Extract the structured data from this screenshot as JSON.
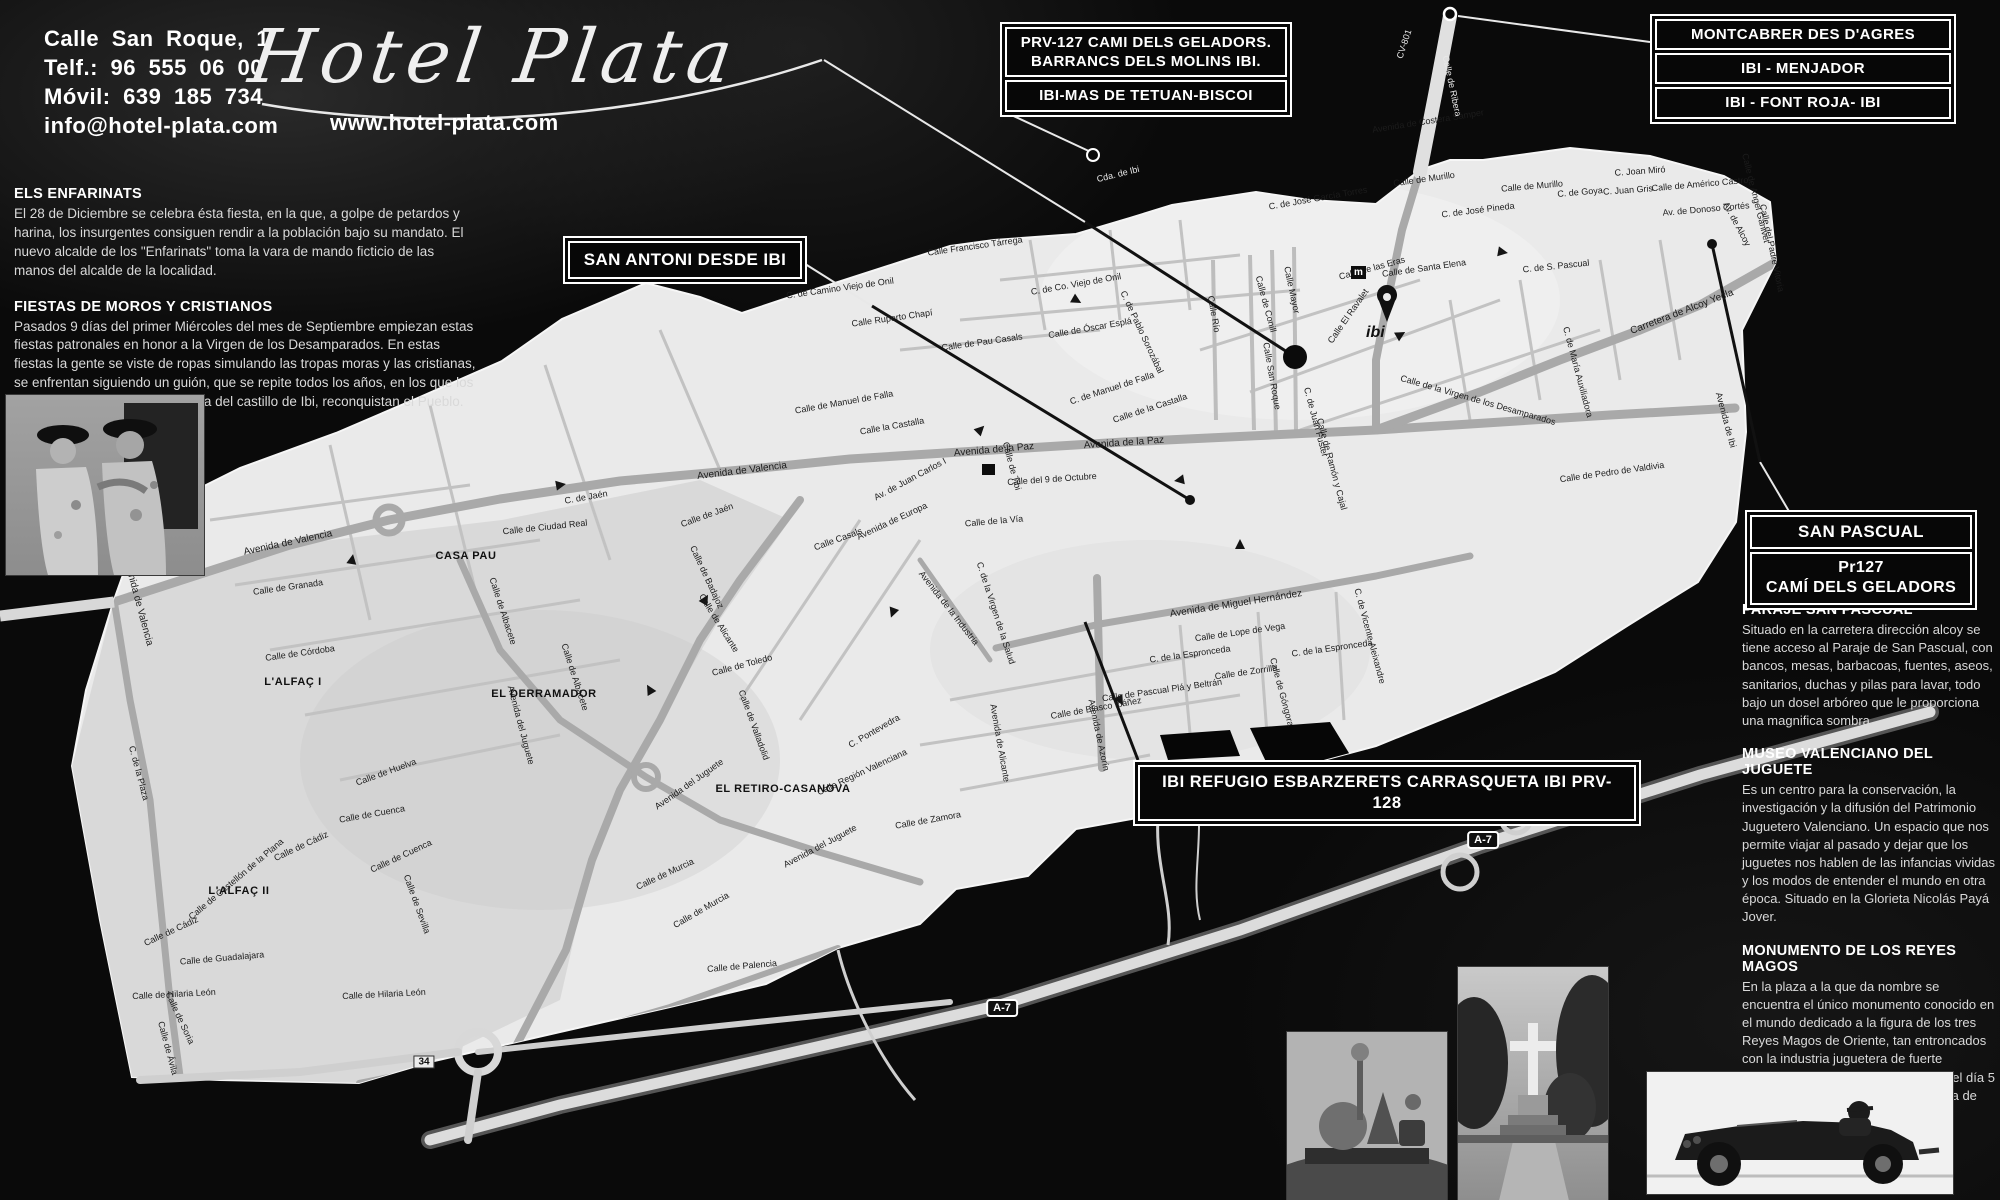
{
  "colors": {
    "background": "#0a0a0a",
    "map_fill": "#e9e9e9",
    "accent_text": "#ffffff"
  },
  "brand": {
    "address": "Calle San Roque, 1",
    "phone": "Telf.: 96 555 06 00",
    "mobile": "Móvil: 639 185 734",
    "email": "info@hotel-plata.com",
    "logo_text": "Hotel Plata",
    "website": "www.hotel-plata.com"
  },
  "callouts": {
    "prv127_line1": "PRV-127 CAMI DELS GELADORS.",
    "prv127_line2": "BARRANCS DELS MOLINS IBI.",
    "prv127_line3": "IBI-MAS DE TETUAN-BISCOI",
    "montcabrer_line1": "MONTCABRER DES D'AGRES",
    "montcabrer_line2": "IBI - MENJADOR",
    "montcabrer_line3": "IBI - FONT ROJA- IBI",
    "san_antoni": "SAN ANTONI DESDE IBI",
    "san_pascual_line1": "SAN PASCUAL",
    "san_pascual_line2": "Pr127",
    "san_pascual_line3": "CAMÍ DELS GELADORS",
    "ibi_refugio": "IBI REFUGIO ESBARZERETS CARRASQUETA IBI PRV-128"
  },
  "left_articles": [
    {
      "title": "ELS ENFARINATS",
      "body": "El 28 de Diciembre se celebra ésta fiesta, en la que, a golpe de petardos y harina, los insurgentes consiguen rendir a la población bajo su mandato. El nuevo alcalde de los \"Enfarinats\" toma la vara de mando ficticio de las manos del alcalde de la localidad."
    },
    {
      "title": "FIESTAS DE MOROS Y CRISTIANOS",
      "body": "Pasados 9 días del primer Miércoles del mes de Septiembre empiezan estas fiestas patronales en honor a la Virgen de los Desamparados. En estas fiestas la gente se viste de ropas simulando las tropas moras y las cristianas, se enfrentan siguiendo un guión, que se repite todos los años, en los que los cristianos, previa conquista mora del castillo de Ibi, reconquistan el Pueblo."
    }
  ],
  "right_articles": [
    {
      "title": "PARAJE SAN PASCUAL",
      "body": "Situado en la carretera dirección alcoy se tiene acceso al Paraje de San Pascual, con bancos, mesas, barbacoas, fuentes, aseos, sanitarios, duchas y pilas para lavar, todo bajo un dosel arbóreo que le proporciona una magnifica sombra."
    },
    {
      "title": "MUSEO VALENCIANO DEL JUGUETE",
      "body": "Es un centro para la conservación, la investigación y la difusión del Patrimonio Juguetero Valenciano. Un espacio que nos permite viajar al pasado y dejar que los juguetes nos hablen de las infancias vividas y los modos de entender el mundo en otra época. Situado en la Glorieta Nicolás Payá Jover."
    },
    {
      "title": "MONUMENTO DE LOS REYES MAGOS",
      "body": "En la plaza a la que da nombre se encuentra el único monumento conocido en el mundo dedicado a la figura de los tres Reyes Magos de Oriente, tan entroncados con la industria juguetera de fuerte implantación en Ibi. Fue inaugurado el día 5 de enero de 1975 y es obra en piedra de Aurelio López Azaustre."
    }
  ],
  "map": {
    "place_label": "ibi",
    "museum_glyph": "m",
    "route_badges": [
      {
        "label": "A-7",
        "x": 1002,
        "y": 1008,
        "kind": "a7"
      },
      {
        "label": "A-7",
        "x": 1483,
        "y": 840,
        "kind": "a7"
      },
      {
        "label": "34",
        "x": 424,
        "y": 1062,
        "kind": "r34"
      }
    ],
    "districts": [
      {
        "t": "CASA PAU",
        "x": 466,
        "y": 556
      },
      {
        "t": "L'ALFAÇ I",
        "x": 293,
        "y": 682
      },
      {
        "t": "L'ALFAÇ II",
        "x": 239,
        "y": 891
      },
      {
        "t": "EL DERRAMADOR",
        "x": 544,
        "y": 694
      },
      {
        "t": "EL RETIRO-CASANOVA",
        "x": 783,
        "y": 789
      }
    ],
    "street_labels": [
      {
        "t": "CV-801",
        "x": 1404,
        "y": 44,
        "r": -72,
        "l": 1
      },
      {
        "t": "Calle de Ribera",
        "x": 1452,
        "y": 86,
        "r": 78,
        "l": 1
      },
      {
        "t": "Avenida de Costera Sàmper",
        "x": 1428,
        "y": 121,
        "r": -9
      },
      {
        "t": "Cda. de Ibi",
        "x": 1118,
        "y": 174,
        "r": -14,
        "l": 1
      },
      {
        "t": "Calle Francisco Tárrega",
        "x": 975,
        "y": 246,
        "r": -8
      },
      {
        "t": "C. de Camino Viejo de Onil",
        "x": 840,
        "y": 288,
        "r": -8
      },
      {
        "t": "C. de Co. Viejo de Onil",
        "x": 1076,
        "y": 284,
        "r": -10
      },
      {
        "t": "Calle Ruperto Chapí",
        "x": 892,
        "y": 318,
        "r": -8
      },
      {
        "t": "Calle de Pau Casals",
        "x": 982,
        "y": 342,
        "r": -8
      },
      {
        "t": "Calle de Óscar Esplá",
        "x": 1090,
        "y": 328,
        "r": -10
      },
      {
        "t": "C. de Pablo Sorozábal",
        "x": 1142,
        "y": 332,
        "r": 65
      },
      {
        "t": "C. de Manuel de Falla",
        "x": 1112,
        "y": 388,
        "r": -18
      },
      {
        "t": "Calle de la Castalla",
        "x": 1150,
        "y": 408,
        "r": -18
      },
      {
        "t": "Calle de Manuel de Falla",
        "x": 844,
        "y": 402,
        "r": -10
      },
      {
        "t": "Calle la Castalla",
        "x": 892,
        "y": 426,
        "r": -10
      },
      {
        "t": "Calle Río",
        "x": 1214,
        "y": 314,
        "r": 80
      },
      {
        "t": "Calle de Conill",
        "x": 1266,
        "y": 304,
        "r": 75
      },
      {
        "t": "Calle Mayor",
        "x": 1292,
        "y": 290,
        "r": 78
      },
      {
        "t": "Calle San Roque",
        "x": 1272,
        "y": 376,
        "r": 80
      },
      {
        "t": "Calle El Ravalet",
        "x": 1348,
        "y": 316,
        "r": -55
      },
      {
        "t": "Calle de las Eras",
        "x": 1372,
        "y": 268,
        "r": -15
      },
      {
        "t": "C. de S. Pascual",
        "x": 1556,
        "y": 266,
        "r": -6
      },
      {
        "t": "Calle de Santa Elena",
        "x": 1424,
        "y": 268,
        "r": -8
      },
      {
        "t": "Calle de Murillo",
        "x": 1424,
        "y": 179,
        "r": -8
      },
      {
        "t": "Calle de Murillo",
        "x": 1532,
        "y": 186,
        "r": -5
      },
      {
        "t": "C. de José García Torres",
        "x": 1318,
        "y": 198,
        "r": -10
      },
      {
        "t": "C. de José Pineda",
        "x": 1478,
        "y": 210,
        "r": -7
      },
      {
        "t": "C. de Goya",
        "x": 1580,
        "y": 192,
        "r": -5
      },
      {
        "t": "C. Joan Miró",
        "x": 1640,
        "y": 171,
        "r": -4
      },
      {
        "t": "C. Juan Gris",
        "x": 1628,
        "y": 190,
        "r": -4
      },
      {
        "t": "Calle de Américo Castro",
        "x": 1700,
        "y": 184,
        "r": -5
      },
      {
        "t": "Av. de Donoso Cortés",
        "x": 1706,
        "y": 209,
        "r": -5
      },
      {
        "t": "Av. de Alcoy",
        "x": 1737,
        "y": 224,
        "r": 62
      },
      {
        "t": "Calle de Angel Ganivet",
        "x": 1756,
        "y": 198,
        "r": 76
      },
      {
        "t": "Calle del Padre Vitoria",
        "x": 1772,
        "y": 248,
        "r": 78
      },
      {
        "t": "Carretera de Alcoy Yecla",
        "x": 1682,
        "y": 312,
        "r": -21,
        "s": 10
      },
      {
        "t": "C. de Juan Fuster",
        "x": 1316,
        "y": 422,
        "r": 75
      },
      {
        "t": "Calle de la Virgen de los Desamparados",
        "x": 1478,
        "y": 400,
        "r": 16
      },
      {
        "t": "C. de María Auxiliadora",
        "x": 1578,
        "y": 372,
        "r": 75
      },
      {
        "t": "Calle de Pedro de Valdivia",
        "x": 1612,
        "y": 472,
        "r": -8
      },
      {
        "t": "Avenida de Ibi",
        "x": 1726,
        "y": 420,
        "r": 75
      },
      {
        "t": "Calle de Ramón y Cajal",
        "x": 1332,
        "y": 464,
        "r": 75
      },
      {
        "t": "Calle de Tibi",
        "x": 1012,
        "y": 466,
        "r": 75
      },
      {
        "t": "Avenida de la Paz",
        "x": 994,
        "y": 450,
        "r": -5,
        "s": 10
      },
      {
        "t": "Avenida de la Paz",
        "x": 1124,
        "y": 443,
        "r": -4,
        "s": 10
      },
      {
        "t": "Calle del 9 de Octubre",
        "x": 1052,
        "y": 479,
        "r": -4
      },
      {
        "t": "Av. de Juan Carlos I",
        "x": 910,
        "y": 479,
        "r": -28
      },
      {
        "t": "Avenida de Valencia",
        "x": 742,
        "y": 471,
        "r": -7,
        "s": 10
      },
      {
        "t": "Avenida de Valencia",
        "x": 288,
        "y": 543,
        "r": -12,
        "s": 10
      },
      {
        "t": "Avenida de Valencia",
        "x": 138,
        "y": 602,
        "r": 75,
        "s": 10
      },
      {
        "t": "Calle de la Vía",
        "x": 994,
        "y": 521,
        "r": -5
      },
      {
        "t": "Avenida de Europa",
        "x": 892,
        "y": 521,
        "r": -25
      },
      {
        "t": "Calle Casals",
        "x": 838,
        "y": 539,
        "r": -20
      },
      {
        "t": "Calle de Jaén",
        "x": 707,
        "y": 515,
        "r": -20
      },
      {
        "t": "C. de Jaén",
        "x": 586,
        "y": 497,
        "r": -10
      },
      {
        "t": "Calle de Ciudad Real",
        "x": 545,
        "y": 527,
        "r": -6
      },
      {
        "t": "Calle de Granada",
        "x": 288,
        "y": 587,
        "r": -8
      },
      {
        "t": "Calle de Córdoba",
        "x": 300,
        "y": 653,
        "r": -8
      },
      {
        "t": "Calle de Albacete",
        "x": 503,
        "y": 611,
        "r": 72
      },
      {
        "t": "Calle de Albacete",
        "x": 575,
        "y": 677,
        "r": 72
      },
      {
        "t": "Calle de Badajoz",
        "x": 707,
        "y": 577,
        "r": 65
      },
      {
        "t": "Calle de Toledo",
        "x": 742,
        "y": 665,
        "r": -15
      },
      {
        "t": "Calle de Valladolid",
        "x": 754,
        "y": 725,
        "r": 70
      },
      {
        "t": "Calle de Alicante",
        "x": 719,
        "y": 623,
        "r": 58
      },
      {
        "t": "Avenida de Alicante",
        "x": 1000,
        "y": 743,
        "r": 80
      },
      {
        "t": "Avenida del Juguete",
        "x": 521,
        "y": 725,
        "r": 75
      },
      {
        "t": "Avenida del Juguete",
        "x": 689,
        "y": 784,
        "r": -35
      },
      {
        "t": "Avenida del Juguete",
        "x": 820,
        "y": 846,
        "r": -28
      },
      {
        "t": "Calle de Cuenca",
        "x": 372,
        "y": 814,
        "r": -10
      },
      {
        "t": "Calle de Cuenca",
        "x": 401,
        "y": 856,
        "r": -25
      },
      {
        "t": "Calle de Huelva",
        "x": 386,
        "y": 772,
        "r": -20
      },
      {
        "t": "Calle de Sevilla",
        "x": 417,
        "y": 904,
        "r": 70
      },
      {
        "t": "Calle de Cádiz",
        "x": 301,
        "y": 846,
        "r": -25
      },
      {
        "t": "Calle de Cádiz",
        "x": 171,
        "y": 931,
        "r": -25
      },
      {
        "t": "Calle de Castellón de la Plana",
        "x": 236,
        "y": 879,
        "r": -40
      },
      {
        "t": "C. de la Plaza",
        "x": 139,
        "y": 773,
        "r": 75
      },
      {
        "t": "Calle de Guadalajara",
        "x": 222,
        "y": 958,
        "r": -5
      },
      {
        "t": "Calle de Hilaria León",
        "x": 174,
        "y": 994,
        "r": -3
      },
      {
        "t": "Calle de Hilaria León",
        "x": 384,
        "y": 994,
        "r": -3
      },
      {
        "t": "Calle de Soria",
        "x": 180,
        "y": 1018,
        "r": 65
      },
      {
        "t": "Calle de Ávila",
        "x": 168,
        "y": 1048,
        "r": 75
      },
      {
        "t": "Calle de Murcia",
        "x": 665,
        "y": 874,
        "r": -25
      },
      {
        "t": "Calle de Murcia",
        "x": 701,
        "y": 910,
        "r": -30
      },
      {
        "t": "Calle de Palencia",
        "x": 742,
        "y": 966,
        "r": -5
      },
      {
        "t": "C. Pontevedra",
        "x": 874,
        "y": 731,
        "r": -30
      },
      {
        "t": "Calle Región Valenciana",
        "x": 862,
        "y": 772,
        "r": -25
      },
      {
        "t": "Calle de Zamora",
        "x": 928,
        "y": 820,
        "r": -10
      },
      {
        "t": "Avenida de la Industria",
        "x": 949,
        "y": 608,
        "r": 52
      },
      {
        "t": "C. de la Virgen de la Salud",
        "x": 996,
        "y": 613,
        "r": 72
      },
      {
        "t": "Avenida de Azorín",
        "x": 1099,
        "y": 735,
        "r": 78
      },
      {
        "t": "Avenida de Miguel Hernández",
        "x": 1236,
        "y": 604,
        "r": -9,
        "s": 10
      },
      {
        "t": "Calle de Lope de Vega",
        "x": 1240,
        "y": 632,
        "r": -8
      },
      {
        "t": "C. de la Espronceda",
        "x": 1190,
        "y": 654,
        "r": -8
      },
      {
        "t": "C. de la Espronceda",
        "x": 1332,
        "y": 648,
        "r": -8
      },
      {
        "t": "Calle de Zorrilla",
        "x": 1246,
        "y": 672,
        "r": -8
      },
      {
        "t": "Calle de Pascual Plá y Beltrán",
        "x": 1162,
        "y": 690,
        "r": -8
      },
      {
        "t": "Calle de Blasco Ibáñez",
        "x": 1096,
        "y": 708,
        "r": -10
      },
      {
        "t": "C. de Vicente Aleixandre",
        "x": 1370,
        "y": 636,
        "r": 75
      },
      {
        "t": "Calle de Góngora",
        "x": 1282,
        "y": 692,
        "r": 75
      }
    ]
  }
}
